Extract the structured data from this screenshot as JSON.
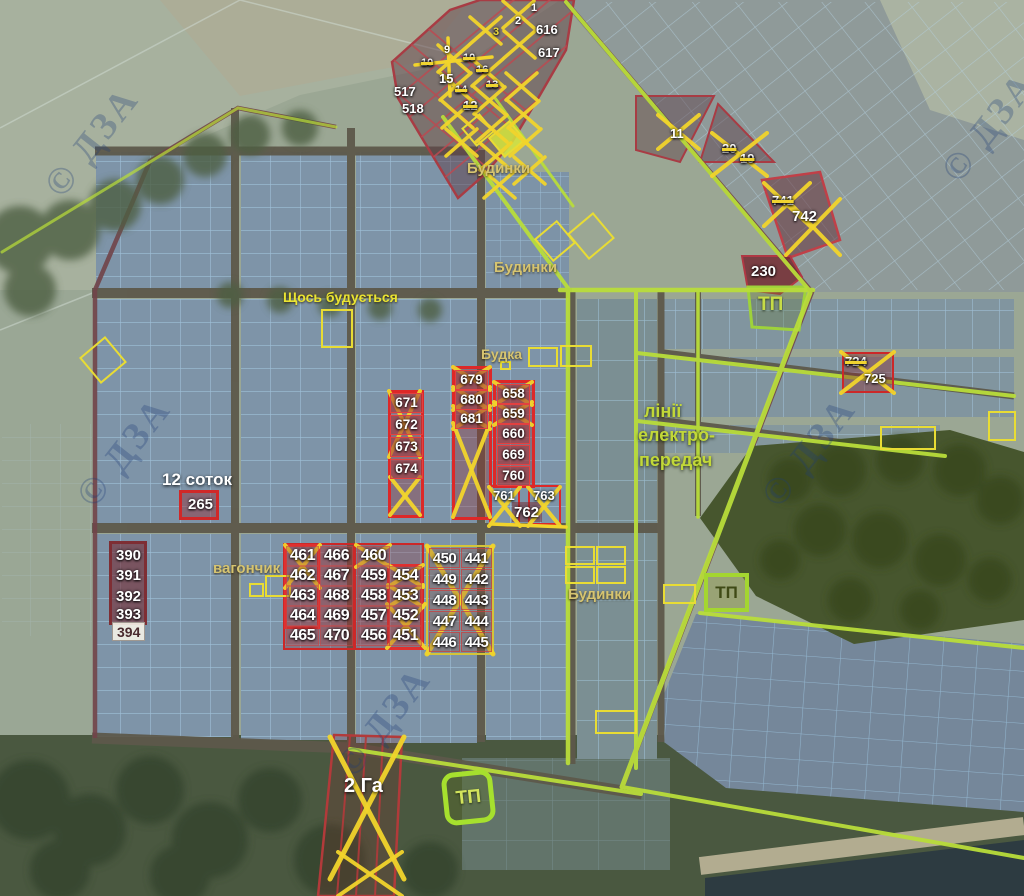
{
  "watermark_text": "© ДЗА",
  "colors": {
    "cross": "#f2d42c",
    "red_border": "#e03030",
    "green_line": "#b9dd3a",
    "blue_grid": "#a6cbe4"
  },
  "area_labels": [
    {
      "text": "Будинки",
      "x": 467,
      "y": 161,
      "cls": "khaki",
      "size": 15
    },
    {
      "text": "Будинки",
      "x": 494,
      "y": 260,
      "cls": "khaki",
      "size": 15
    },
    {
      "text": "Будинки",
      "x": 568,
      "y": 587,
      "cls": "khaki",
      "size": 15
    },
    {
      "text": "Щось будується",
      "x": 283,
      "y": 290,
      "cls": "yellow",
      "size": 14
    },
    {
      "text": "Будка",
      "x": 481,
      "y": 347,
      "cls": "khaki",
      "size": 14
    },
    {
      "text": "вагончик",
      "x": 213,
      "y": 561,
      "cls": "khaki",
      "size": 15
    },
    {
      "text": "лінії",
      "x": 644,
      "y": 402,
      "cls": "green",
      "size": 18
    },
    {
      "text": "електро-",
      "x": 638,
      "y": 426,
      "cls": "green",
      "size": 18
    },
    {
      "text": "передач",
      "x": 639,
      "y": 451,
      "cls": "green",
      "size": 18
    },
    {
      "text": "12 соток",
      "x": 162,
      "y": 471,
      "cls": "white",
      "size": 17
    },
    {
      "text": "2 Га",
      "x": 344,
      "y": 776,
      "cls": "white",
      "size": 20
    }
  ],
  "tp_stations": [
    {
      "label": "ТП",
      "x": 758,
      "y": 294,
      "variant": "plain",
      "size": 19
    },
    {
      "label": "ТП",
      "x": 704,
      "y": 573,
      "w": 45,
      "h": 39,
      "variant": "box",
      "size": 17
    },
    {
      "label": "ТП",
      "x": 443,
      "y": 771,
      "w": 51,
      "h": 53,
      "variant": "round",
      "size": 19
    }
  ],
  "plot_markers": [
    {
      "n": "1",
      "x": 531,
      "y": 3,
      "cls": "t"
    },
    {
      "n": "2",
      "x": 515,
      "y": 16,
      "cls": "t"
    },
    {
      "n": "616",
      "x": 536,
      "y": 23,
      "cls": "s"
    },
    {
      "n": "617",
      "x": 538,
      "y": 46,
      "cls": "s"
    },
    {
      "n": "3",
      "x": 493,
      "y": 27,
      "cls": "t",
      "yellow": true
    },
    {
      "n": "9",
      "x": 444,
      "y": 45,
      "cls": "t"
    },
    {
      "n": "10",
      "x": 421,
      "y": 58,
      "cls": "t",
      "strike": true
    },
    {
      "n": "10",
      "x": 463,
      "y": 53,
      "cls": "t",
      "strike": true
    },
    {
      "n": "15",
      "x": 439,
      "y": 72,
      "cls": "s"
    },
    {
      "n": "16",
      "x": 476,
      "y": 65,
      "cls": "t",
      "strike": true
    },
    {
      "n": "14",
      "x": 455,
      "y": 85,
      "cls": "t",
      "strike": true
    },
    {
      "n": "13",
      "x": 486,
      "y": 80,
      "cls": "t",
      "strike": true
    },
    {
      "n": "12",
      "x": 463,
      "y": 99,
      "cls": "s",
      "strike": true
    },
    {
      "n": "517",
      "x": 394,
      "y": 85,
      "cls": "s"
    },
    {
      "n": "518",
      "x": 402,
      "y": 102,
      "cls": "s"
    },
    {
      "n": "11",
      "x": 670,
      "y": 127,
      "cls": "s"
    },
    {
      "n": "20",
      "x": 722,
      "y": 142,
      "cls": "s",
      "strike": true
    },
    {
      "n": "19",
      "x": 740,
      "y": 152,
      "cls": "s",
      "strike": true
    },
    {
      "n": "741",
      "x": 772,
      "y": 194,
      "cls": "s",
      "strike": true
    },
    {
      "n": "742",
      "x": 792,
      "y": 209,
      "cls": "m"
    },
    {
      "n": "230",
      "x": 751,
      "y": 264,
      "cls": "m"
    },
    {
      "n": "724",
      "x": 845,
      "y": 355,
      "cls": "s",
      "strike": true
    },
    {
      "n": "725",
      "x": 864,
      "y": 372,
      "cls": "s"
    },
    {
      "n": "671",
      "x": 390,
      "y": 393,
      "cls": "cell"
    },
    {
      "n": "672",
      "x": 390,
      "y": 415,
      "cls": "cell"
    },
    {
      "n": "673",
      "x": 390,
      "y": 437,
      "cls": "cell"
    },
    {
      "n": "674",
      "x": 390,
      "y": 459,
      "cls": "cell"
    },
    {
      "n": "679",
      "x": 455,
      "y": 370,
      "cls": "cell"
    },
    {
      "n": "680",
      "x": 455,
      "y": 390,
      "cls": "cell"
    },
    {
      "n": "681",
      "x": 455,
      "y": 409,
      "cls": "cell"
    },
    {
      "n": "658",
      "x": 497,
      "y": 384,
      "cls": "cell"
    },
    {
      "n": "659",
      "x": 497,
      "y": 404,
      "cls": "cell"
    },
    {
      "n": "660",
      "x": 497,
      "y": 424,
      "cls": "cell"
    },
    {
      "n": "669",
      "x": 497,
      "y": 445,
      "cls": "cell"
    },
    {
      "n": "760",
      "x": 497,
      "y": 466,
      "cls": "cell"
    },
    {
      "n": "761",
      "x": 493,
      "y": 489,
      "cls": "s"
    },
    {
      "n": "762",
      "x": 514,
      "y": 505,
      "cls": "m"
    },
    {
      "n": "763",
      "x": 533,
      "y": 489,
      "cls": "s"
    },
    {
      "n": "265",
      "x": 188,
      "y": 497,
      "cls": "m"
    },
    {
      "n": "390",
      "x": 116,
      "y": 548,
      "cls": "m"
    },
    {
      "n": "391",
      "x": 116,
      "y": 568,
      "cls": "m"
    },
    {
      "n": "392",
      "x": 116,
      "y": 589,
      "cls": "m"
    },
    {
      "n": "393",
      "x": 116,
      "y": 607,
      "cls": "m"
    },
    {
      "n": "394",
      "x": 112,
      "y": 622,
      "cls": "light"
    },
    {
      "n": "461",
      "x": 286,
      "y": 546,
      "cls": "cellb"
    },
    {
      "n": "462",
      "x": 286,
      "y": 566,
      "cls": "cellb"
    },
    {
      "n": "463",
      "x": 286,
      "y": 586,
      "cls": "cellb"
    },
    {
      "n": "464",
      "x": 286,
      "y": 606,
      "cls": "cellb"
    },
    {
      "n": "465",
      "x": 286,
      "y": 626,
      "cls": "cellb"
    },
    {
      "n": "466",
      "x": 320,
      "y": 546,
      "cls": "cellb"
    },
    {
      "n": "467",
      "x": 320,
      "y": 566,
      "cls": "cellb"
    },
    {
      "n": "468",
      "x": 320,
      "y": 586,
      "cls": "cellb"
    },
    {
      "n": "469",
      "x": 320,
      "y": 606,
      "cls": "cellb"
    },
    {
      "n": "470",
      "x": 320,
      "y": 626,
      "cls": "cellb"
    },
    {
      "n": "460",
      "x": 357,
      "y": 546,
      "cls": "cellb"
    },
    {
      "n": "459",
      "x": 357,
      "y": 566,
      "cls": "cellb"
    },
    {
      "n": "458",
      "x": 357,
      "y": 586,
      "cls": "cellb"
    },
    {
      "n": "457",
      "x": 357,
      "y": 606,
      "cls": "cellb"
    },
    {
      "n": "456",
      "x": 357,
      "y": 626,
      "cls": "cellb"
    },
    {
      "n": "454",
      "x": 389,
      "y": 566,
      "cls": "cellb"
    },
    {
      "n": "453",
      "x": 389,
      "y": 586,
      "cls": "cellb"
    },
    {
      "n": "452",
      "x": 389,
      "y": 606,
      "cls": "cellb"
    },
    {
      "n": "451",
      "x": 389,
      "y": 626,
      "cls": "cellb"
    },
    {
      "n": "450",
      "x": 429,
      "y": 548,
      "cls": "cellc"
    },
    {
      "n": "449",
      "x": 429,
      "y": 569,
      "cls": "cellc"
    },
    {
      "n": "448",
      "x": 429,
      "y": 590,
      "cls": "cellc"
    },
    {
      "n": "447",
      "x": 429,
      "y": 611,
      "cls": "cellc"
    },
    {
      "n": "446",
      "x": 429,
      "y": 632,
      "cls": "cellc"
    },
    {
      "n": "441",
      "x": 461,
      "y": 548,
      "cls": "cellc"
    },
    {
      "n": "442",
      "x": 461,
      "y": 569,
      "cls": "cellc"
    },
    {
      "n": "443",
      "x": 461,
      "y": 590,
      "cls": "cellc"
    },
    {
      "n": "444",
      "x": 461,
      "y": 611,
      "cls": "cellc"
    },
    {
      "n": "445",
      "x": 461,
      "y": 632,
      "cls": "cellc"
    }
  ],
  "group_boxes": [
    {
      "x": 283,
      "y": 543,
      "w": 72,
      "h": 107,
      "bc": "#cc2828",
      "bw": 2.5,
      "bg": "rgba(150,45,50,0.3)"
    },
    {
      "x": 284,
      "y": 544,
      "w": 36,
      "h": 85,
      "bc": "#e03030",
      "bw": 3
    },
    {
      "x": 354,
      "y": 543,
      "w": 70,
      "h": 107,
      "bc": "#cc2828",
      "bw": 2.5,
      "bg": "rgba(150,45,50,0.3)"
    },
    {
      "x": 387,
      "y": 564,
      "w": 36,
      "h": 86,
      "bc": "#e03030",
      "bw": 3
    },
    {
      "x": 426,
      "y": 545,
      "w": 68,
      "h": 110,
      "bc": "#d4c438",
      "bw": 2.5,
      "bg": "rgba(150,120,40,0.12)"
    },
    {
      "x": 388,
      "y": 390,
      "w": 36,
      "h": 128,
      "bc": "#dd2828",
      "bw": 3,
      "bg": "rgba(150,45,50,0.35)"
    },
    {
      "x": 452,
      "y": 366,
      "w": 40,
      "h": 154,
      "bc": "#dd2828",
      "bw": 3,
      "bg": "rgba(150,45,50,0.35)"
    },
    {
      "x": 493,
      "y": 380,
      "w": 42,
      "h": 108,
      "bc": "#dd2828",
      "bw": 3,
      "bg": "rgba(150,45,50,0.35)"
    },
    {
      "x": 489,
      "y": 485,
      "w": 31,
      "h": 40,
      "bc": "#dd2828",
      "bw": 2.5
    },
    {
      "x": 528,
      "y": 485,
      "w": 33,
      "h": 40,
      "bc": "#dd2828",
      "bw": 2.5
    },
    {
      "x": 512,
      "y": 502,
      "w": 30,
      "h": 20,
      "bc": "rgba(0,0,0,0)",
      "bw": 1,
      "bg": "rgba(120,40,45,0.5)"
    },
    {
      "x": 179,
      "y": 490,
      "w": 40,
      "h": 30,
      "bc": "#d02828",
      "bw": 3,
      "bg": "rgba(150,45,50,0.45)"
    },
    {
      "x": 109,
      "y": 541,
      "w": 38,
      "h": 84,
      "bc": "#7e2e34",
      "bw": 3.5,
      "bg": "rgba(118,42,48,0.6)"
    },
    {
      "x": 842,
      "y": 352,
      "w": 52,
      "h": 41,
      "bc": "#cc2828",
      "bw": 2.5,
      "bg": "rgba(140,40,45,0.4)"
    }
  ],
  "highlight_boxes": [
    {
      "x": 321,
      "y": 309,
      "w": 32,
      "h": 39
    },
    {
      "x": 500,
      "y": 361,
      "w": 11,
      "h": 9
    },
    {
      "x": 528,
      "y": 347,
      "w": 30,
      "h": 20
    },
    {
      "x": 560,
      "y": 345,
      "w": 32,
      "h": 22
    },
    {
      "x": 540,
      "y": 226,
      "w": 30,
      "h": 30,
      "rot": -40
    },
    {
      "x": 574,
      "y": 219,
      "w": 34,
      "h": 34,
      "rot": -40
    },
    {
      "x": 249,
      "y": 583,
      "w": 15,
      "h": 14
    },
    {
      "x": 265,
      "y": 575,
      "w": 26,
      "h": 22
    },
    {
      "x": 565,
      "y": 546,
      "w": 30,
      "h": 19
    },
    {
      "x": 596,
      "y": 546,
      "w": 30,
      "h": 19
    },
    {
      "x": 565,
      "y": 566,
      "w": 30,
      "h": 18
    },
    {
      "x": 596,
      "y": 566,
      "w": 30,
      "h": 18
    },
    {
      "x": 663,
      "y": 584,
      "w": 33,
      "h": 20
    },
    {
      "x": 595,
      "y": 710,
      "w": 42,
      "h": 24
    },
    {
      "x": 880,
      "y": 426,
      "w": 56,
      "h": 24
    },
    {
      "x": 988,
      "y": 411,
      "w": 28,
      "h": 30
    },
    {
      "x": 86,
      "y": 343,
      "w": 34,
      "h": 34,
      "rot": -40
    },
    {
      "x": 466,
      "y": 118,
      "w": 24,
      "h": 24,
      "rot": -40
    },
    {
      "x": 493,
      "y": 126,
      "w": 28,
      "h": 26,
      "rot": -40,
      "fill": "rgba(214,230,60,0.85)"
    }
  ],
  "cross_marks": [
    {
      "x": 427,
      "y": 546,
      "w": 66,
      "h": 108,
      "sw": 5
    },
    {
      "x": 285,
      "y": 545,
      "w": 35,
      "h": 43
    },
    {
      "x": 356,
      "y": 545,
      "w": 34,
      "h": 22
    },
    {
      "x": 388,
      "y": 565,
      "w": 35,
      "h": 22
    },
    {
      "x": 388,
      "y": 585,
      "w": 35,
      "h": 22
    },
    {
      "x": 387,
      "y": 604,
      "w": 38,
      "h": 44
    },
    {
      "x": 389,
      "y": 391,
      "w": 31,
      "h": 66
    },
    {
      "x": 390,
      "y": 477,
      "w": 30,
      "h": 38
    },
    {
      "x": 453,
      "y": 367,
      "w": 37,
      "h": 23
    },
    {
      "x": 453,
      "y": 387,
      "w": 37,
      "h": 23
    },
    {
      "x": 453,
      "y": 406,
      "w": 37,
      "h": 23
    },
    {
      "x": 453,
      "y": 423,
      "w": 37,
      "h": 94
    },
    {
      "x": 494,
      "y": 382,
      "w": 38,
      "h": 23
    },
    {
      "x": 494,
      "y": 402,
      "w": 38,
      "h": 23
    },
    {
      "x": 489,
      "y": 487,
      "w": 31,
      "h": 39
    },
    {
      "x": 528,
      "y": 487,
      "w": 32,
      "h": 39
    },
    {
      "x": 841,
      "y": 352,
      "w": 53,
      "h": 41
    },
    {
      "x": 764,
      "y": 183,
      "w": 46,
      "h": 43
    },
    {
      "x": 786,
      "y": 199,
      "w": 54,
      "h": 56
    },
    {
      "x": 658,
      "y": 115,
      "w": 41,
      "h": 34
    },
    {
      "x": 712,
      "y": 133,
      "w": 55,
      "h": 43
    },
    {
      "x": 330,
      "y": 737,
      "w": 74,
      "h": 142,
      "sw": 5
    },
    {
      "x": 338,
      "y": 852,
      "w": 64,
      "h": 44
    },
    {
      "x": 503,
      "y": 1,
      "w": 31,
      "h": 27,
      "sw": 3.5
    },
    {
      "x": 470,
      "y": 17,
      "w": 31,
      "h": 27,
      "sw": 3.5
    },
    {
      "x": 504,
      "y": 31,
      "w": 31,
      "h": 27,
      "sw": 3.5
    },
    {
      "x": 438,
      "y": 45,
      "w": 31,
      "h": 27,
      "sw": 3.5
    },
    {
      "x": 472,
      "y": 59,
      "w": 31,
      "h": 27,
      "sw": 3.5
    },
    {
      "x": 506,
      "y": 73,
      "w": 31,
      "h": 27,
      "sw": 3.5
    },
    {
      "x": 440,
      "y": 73,
      "w": 31,
      "h": 27,
      "sw": 3.5
    },
    {
      "x": 474,
      "y": 87,
      "w": 31,
      "h": 27,
      "sw": 3.5
    },
    {
      "x": 508,
      "y": 101,
      "w": 31,
      "h": 27,
      "sw": 3.5
    },
    {
      "x": 442,
      "y": 101,
      "w": 31,
      "h": 27,
      "sw": 3.5
    },
    {
      "x": 476,
      "y": 115,
      "w": 31,
      "h": 27,
      "sw": 3.5
    },
    {
      "x": 510,
      "y": 129,
      "w": 31,
      "h": 27,
      "sw": 3.5
    },
    {
      "x": 446,
      "y": 129,
      "w": 31,
      "h": 27,
      "sw": 3.5
    },
    {
      "x": 480,
      "y": 143,
      "w": 31,
      "h": 27,
      "sw": 3.5
    },
    {
      "x": 514,
      "y": 157,
      "w": 31,
      "h": 27,
      "sw": 3.5
    },
    {
      "x": 484,
      "y": 171,
      "w": 31,
      "h": 27,
      "sw": 3.5
    }
  ],
  "yellow_lines": [
    {
      "x1": 415,
      "y1": 65,
      "x2": 492,
      "y2": 57
    },
    {
      "x1": 448,
      "y1": 38,
      "x2": 450,
      "y2": 96
    },
    {
      "x1": 491,
      "y1": 524,
      "x2": 566,
      "y2": 527
    }
  ],
  "watermarks": [
    {
      "x": 28,
      "y": 120
    },
    {
      "x": 925,
      "y": 105
    },
    {
      "x": 60,
      "y": 430
    },
    {
      "x": 320,
      "y": 700
    },
    {
      "x": 745,
      "y": 430
    }
  ]
}
